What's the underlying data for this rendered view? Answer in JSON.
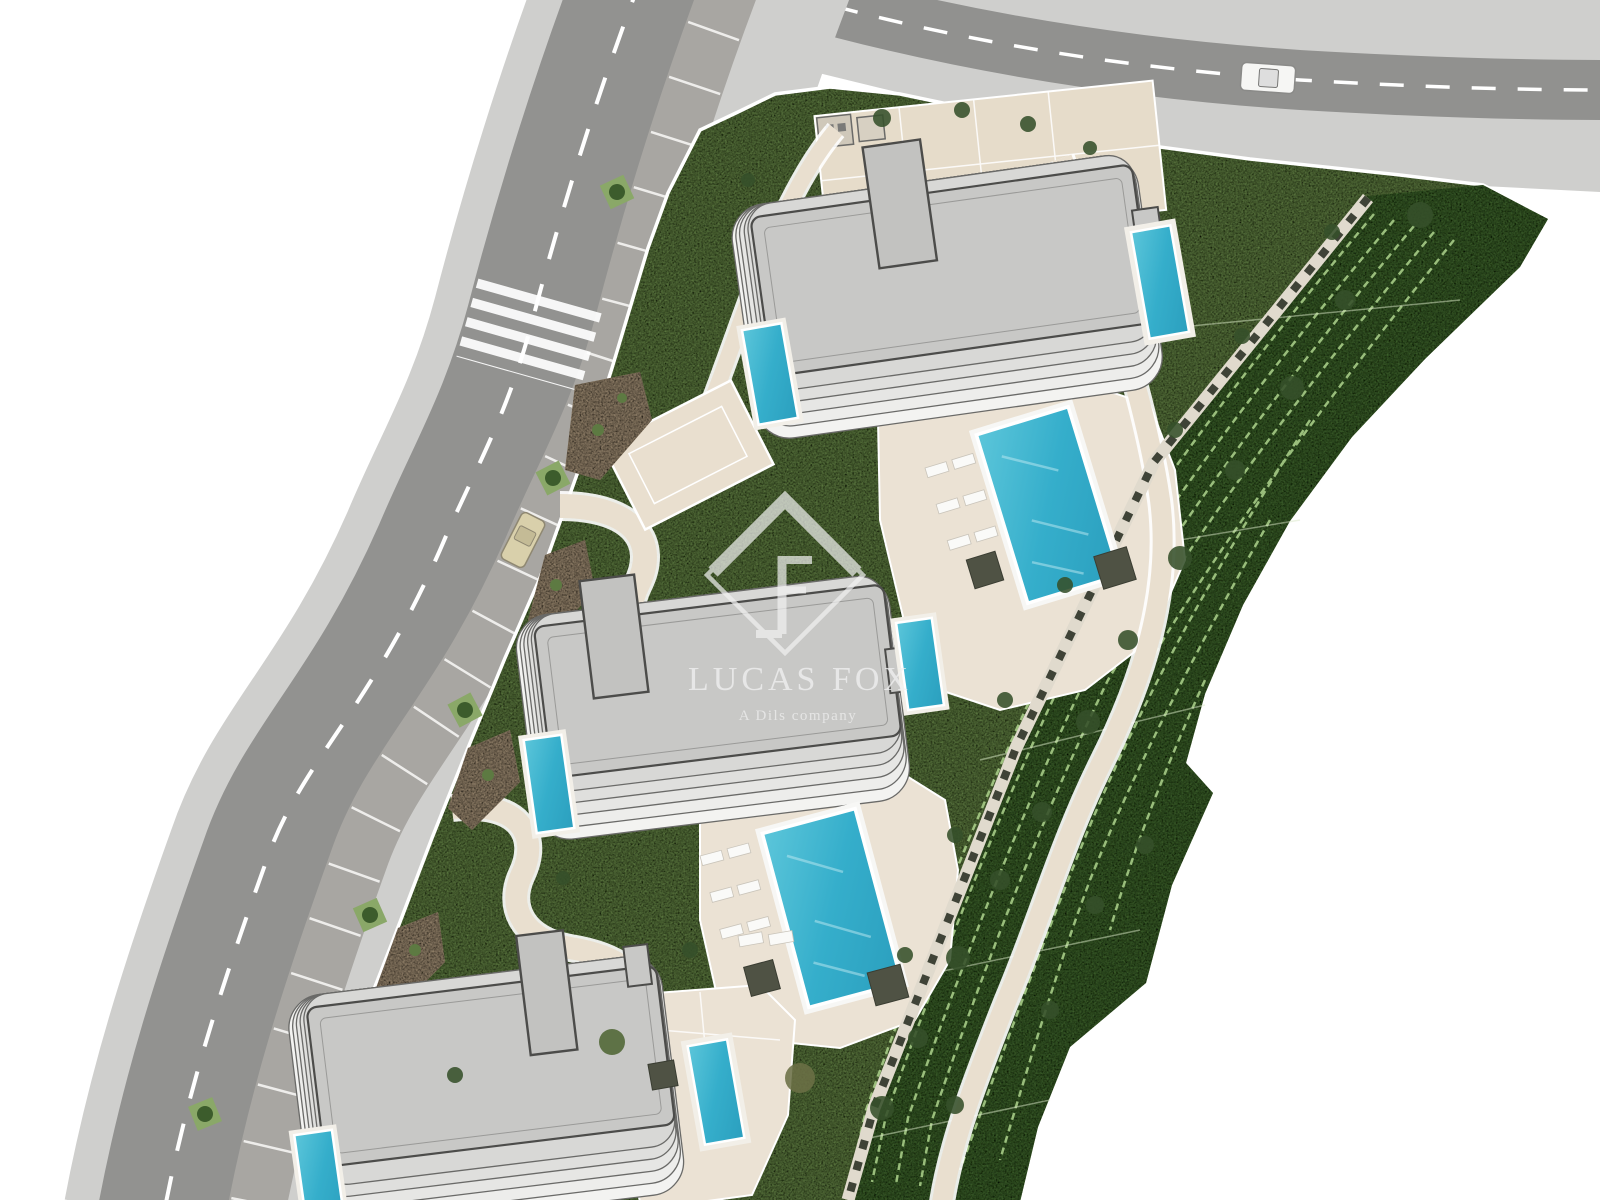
{
  "watermark": {
    "brand": "LUCAS FOX",
    "tagline": "A Dils company",
    "logo_icon": "lf-diamond-icon"
  },
  "colors": {
    "background": "#ffffff",
    "asphalt": "#919191",
    "sidewalk": "#cfcfcd",
    "parking_strip": "#a8a6a2",
    "road_marking": "#ffffff",
    "lawn": "#6f9150",
    "slope_green": "#4c7437",
    "hedge_line": "#aed48d",
    "hardscape_path": "#e9dfcf",
    "pool_deck": "#ebe2d4",
    "building_roof": "#c8c8c6",
    "building_terrace": "#f1f1ef",
    "building_outline": "#4c4c4a",
    "pool_water": "#3cb4ce",
    "pool_coping": "#ffffff",
    "planter": "#4f5244",
    "paver": "#3f4337",
    "dirt_bed": "#b5a084",
    "tree": "#35502a",
    "car_white": "#f6f6f4",
    "car_beige": "#d9d0ab"
  },
  "scene": {
    "kind": "aerial residential site plan rendering",
    "buildings": 3,
    "communal_pools": 2,
    "terrace_pools": 6,
    "roads": 2,
    "cars": 2,
    "crosswalks": 1
  }
}
